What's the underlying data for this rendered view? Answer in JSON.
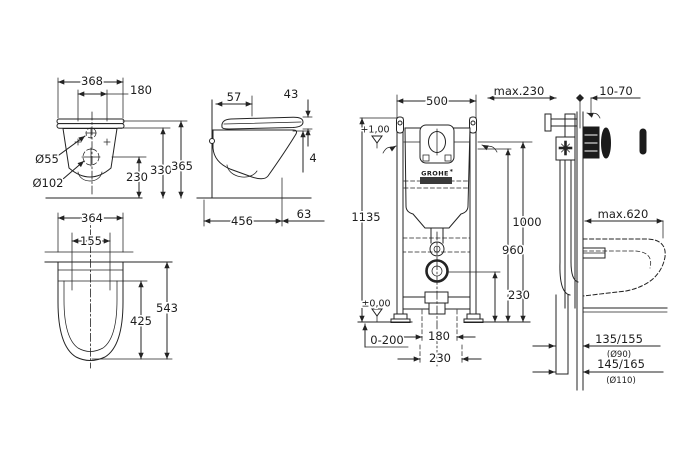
{
  "views": {
    "front": {
      "d368": "368",
      "d180": "180",
      "d55": "Ø55",
      "d102": "Ø102",
      "d230": "230",
      "d330": "330",
      "d365": "365"
    },
    "side": {
      "d57": "57",
      "d43": "43",
      "d4": "4",
      "d456": "456",
      "d63": "63"
    },
    "plan": {
      "d364": "364",
      "d155": "155",
      "d425": "425",
      "d543": "543"
    },
    "frame_front": {
      "d500": "500",
      "level_plus": "+1,00",
      "d1135": "1135",
      "d1000": "1000",
      "d960": "960",
      "d230_outlet": "230",
      "level_zero": "±0,00",
      "d0_200": "0-200",
      "d180": "180",
      "d230_drain": "230",
      "brand": "GROHE",
      "brand_mark": "*"
    },
    "frame_side": {
      "dmax230": "max.230",
      "d10_70": "10-70",
      "dmax620": "max.620",
      "d135_155": "135/155",
      "d90": "(Ø90)",
      "d145_165": "145/165",
      "d110": "(Ø110)"
    }
  },
  "colors": {
    "line": "#232323",
    "background": "#ffffff",
    "brand_box": "#1b1b1b",
    "brand_text": "#ffffff"
  }
}
